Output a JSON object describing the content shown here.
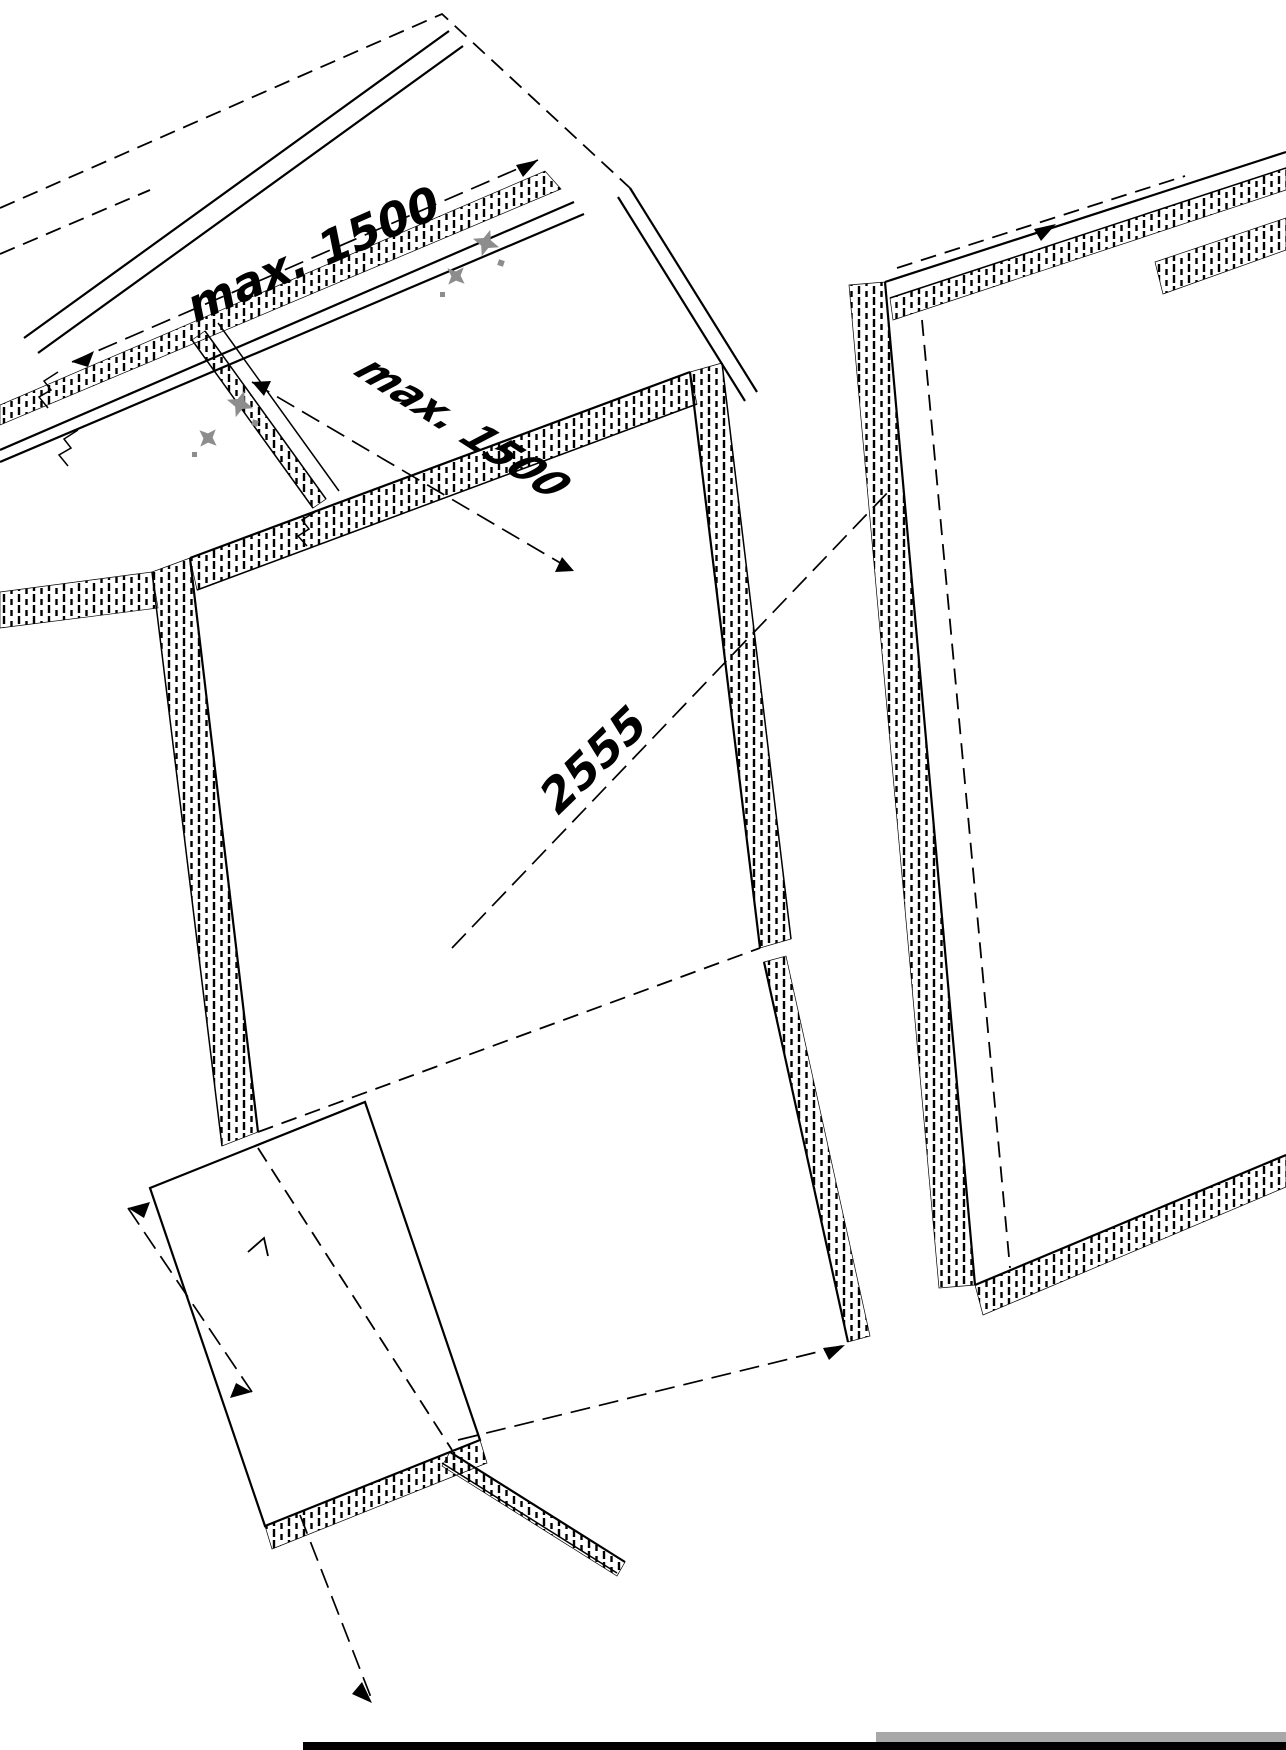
{
  "drawing": {
    "title": "isometric-panel-assembly-diagram",
    "background_color": "#ffffff",
    "line_color": "#000000",
    "screw_color": "#8d8d8d",
    "page_rule_color": "#000000",
    "gray_strip_color": "#a8a8a8",
    "labels": {
      "top_rail_spacing": "max. 1500",
      "side_rail_spacing": "max. 1500",
      "panel_edge_dimension": "2555"
    },
    "icons": [
      {
        "name": "screw-fixing-icon"
      },
      {
        "name": "screw-fixing-icon"
      }
    ]
  }
}
